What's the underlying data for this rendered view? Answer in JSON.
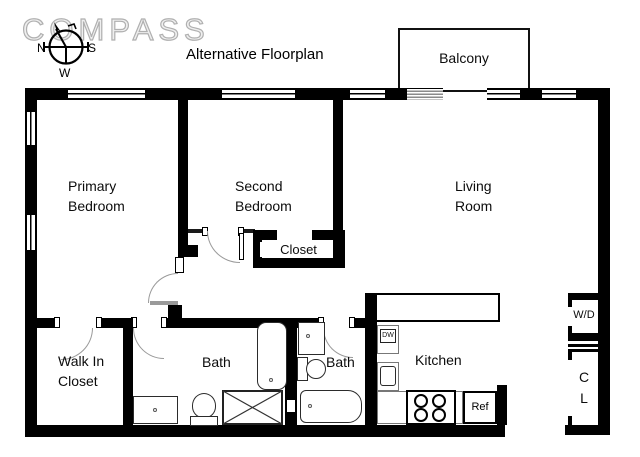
{
  "header": {
    "logo": "COMPASS",
    "title": "Alternative Floorplan"
  },
  "compass_rose": {
    "north": "N",
    "south": "S",
    "west": "W"
  },
  "rooms": {
    "balcony": "Balcony",
    "primary_bedroom": "Primary\nBedroom",
    "second_bedroom": "Second\nBedroom",
    "living_room": "Living\nRoom",
    "bedroom_closet": "Closet",
    "walk_in_closet": "Walk In\nCloset",
    "bath_1": "Bath",
    "bath_2": "Bath",
    "kitchen": "Kitchen",
    "hall_closet": "C\nL"
  },
  "appliances": {
    "dishwasher": "DW",
    "refrigerator": "Ref",
    "washer_dryer": "W/D"
  },
  "colors": {
    "wall": "#000000",
    "background": "#ffffff",
    "logo_outline": "#b0b0b0",
    "door_arc": "#9a9a9a"
  }
}
